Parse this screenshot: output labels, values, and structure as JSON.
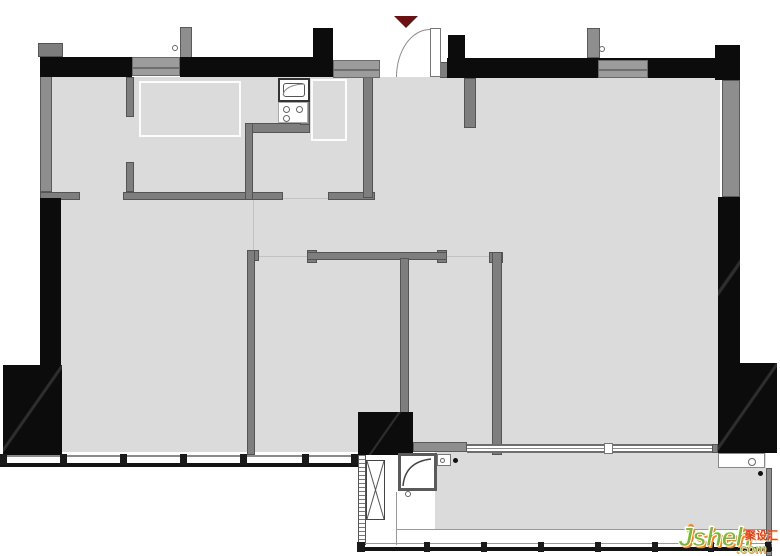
{
  "document": {
    "type": "apartment-floor-plan",
    "orientation_marker": "entrance-triangle"
  },
  "watermark": {
    "brand": "Jsheh",
    "tld": ".com",
    "cn_label": "聚设汇"
  },
  "palette": {
    "floor": "#dbdbdb",
    "wall_black": "#0c0c0c",
    "wall_gray": "#7e7e7e",
    "window_gray": "#9c9c9c",
    "marker_red": "#6b1111",
    "watermark_green": "#7cb63e",
    "watermark_orange": "#f08619",
    "watermark_red": "#e34022"
  },
  "fixtures": [
    "entry-door-swing",
    "kitchen-sink",
    "kitchen-stove-3-burners",
    "utility-shaft-x",
    "water-heater-unit",
    "balcony-sliding-track",
    "window-rail-south",
    "window-rail-balcony"
  ]
}
